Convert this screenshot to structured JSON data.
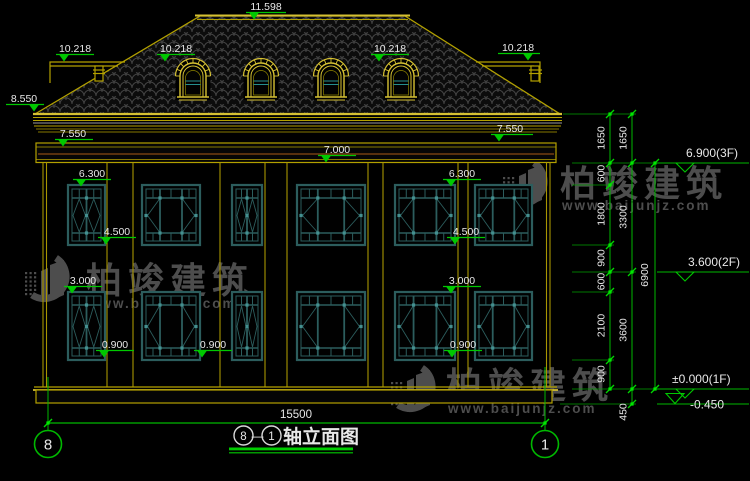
{
  "page": {
    "background": "#000000"
  },
  "title": {
    "axis_from": "8",
    "axis_sep": "—",
    "axis_to": "1",
    "label": "轴立面图"
  },
  "axis_bubbles": {
    "left": "8",
    "right": "1"
  },
  "dims": {
    "overall_width": "15500",
    "col1": [
      "1650",
      "600",
      "1800",
      "900",
      "600",
      "2100",
      "900"
    ],
    "col2": [
      "1650",
      "3300",
      "3600",
      "450"
    ],
    "col3": [
      "6900"
    ]
  },
  "spot_levels": {
    "ridge": "11.598",
    "side_roof": "10.218",
    "eave": "8.550",
    "band": "7.550",
    "parapet": "7.000",
    "f2_head": "6.300",
    "f2_sill": "4.500",
    "f1_head": "3.000",
    "f1_sill": "0.900"
  },
  "floor_levels": [
    {
      "value": "6.900(3F)"
    },
    {
      "value": "3.600(2F)"
    },
    {
      "value": "±0.000(1F)"
    },
    {
      "value": "-0.450"
    }
  ],
  "watermark": {
    "brand": "柏竣建筑",
    "url": "www.baijunjz.com"
  },
  "colors": {
    "line_yellow": "#b3a100",
    "line_yellow_bright": "#d6c133",
    "dim_green": "#00b800",
    "marker_green": "#00d000",
    "window_teal": "#2c5d5d",
    "accent_cyan": "#2aa0a0",
    "text_white": "#e8e8e8",
    "frieze_brown": "#8a4a14",
    "watermark_gray": "#9a9a9a"
  }
}
